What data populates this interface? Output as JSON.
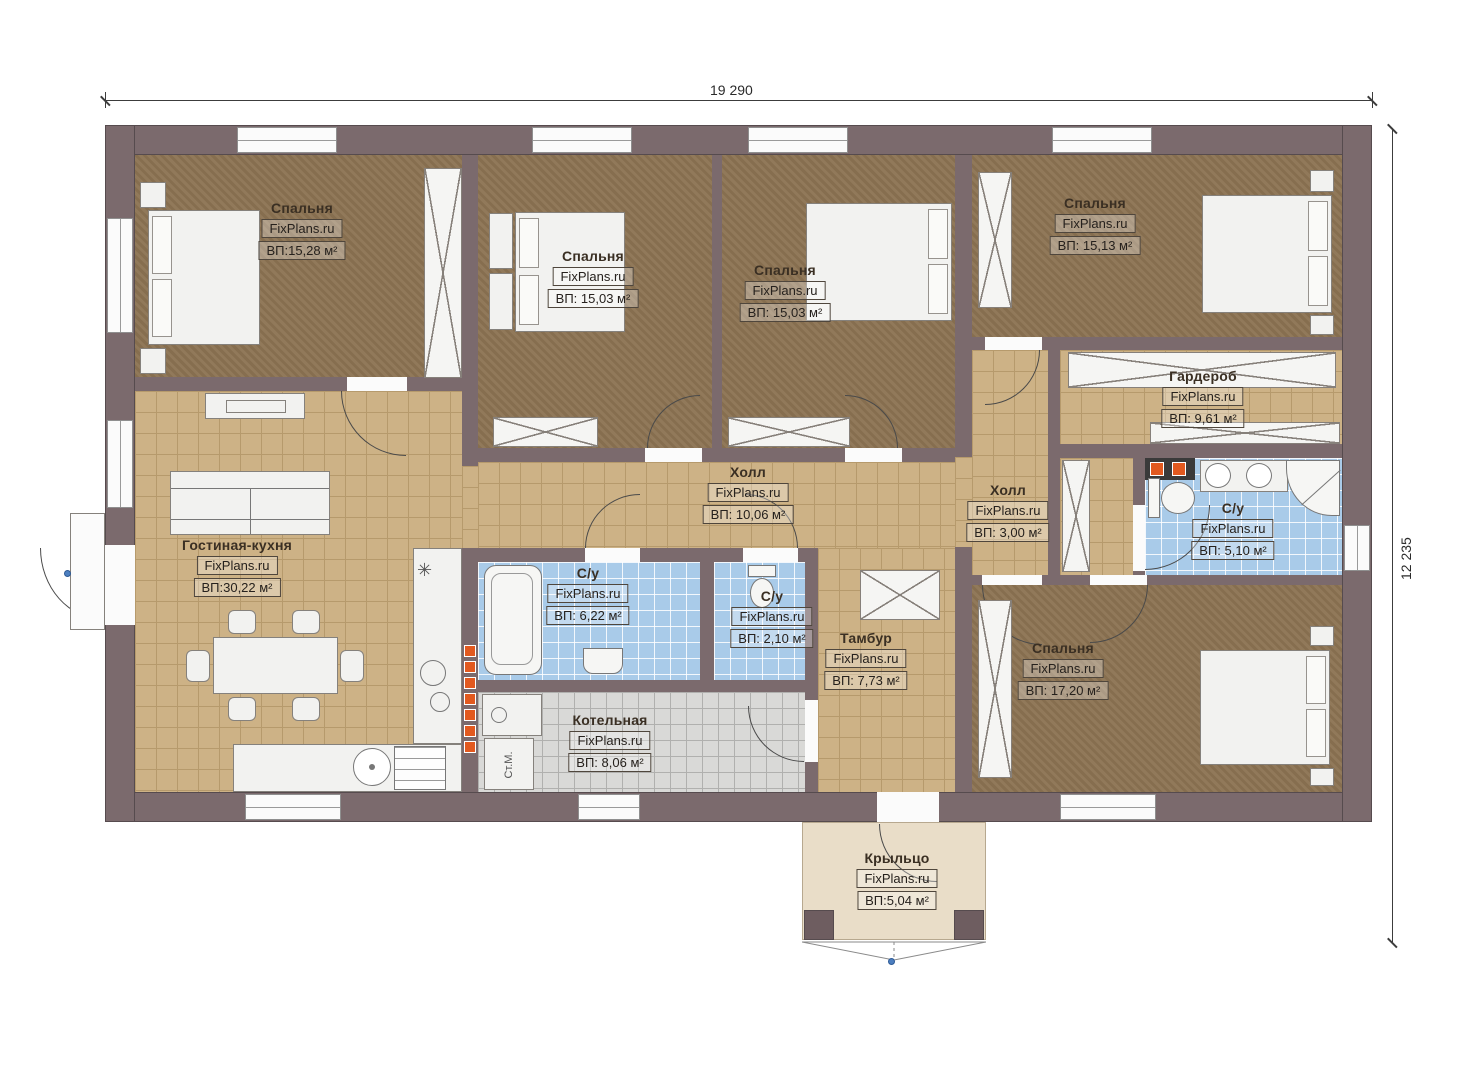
{
  "watermark": "FixPlans.ru",
  "dimensions": {
    "width": "19 290",
    "height": "12 235"
  },
  "labels": {
    "washing_machine": "Ст.М.",
    "kitchen_symbol": "✳"
  },
  "rooms": {
    "bedroom1": {
      "name": "Спальня",
      "area": "ВП:15,28 м²"
    },
    "bedroom2": {
      "name": "Спальня",
      "area": "ВП: 15,03 м²"
    },
    "bedroom3": {
      "name": "Спальня",
      "area": "ВП: 15,03 м²"
    },
    "bedroom4": {
      "name": "Спальня",
      "area": "ВП: 15,13 м²"
    },
    "bedroom5": {
      "name": "Спальня",
      "area": "ВП: 17,20 м²"
    },
    "wardrobe": {
      "name": "Гардероб",
      "area": "ВП: 9,61 м²"
    },
    "hall_main": {
      "name": "Холл",
      "area": "ВП: 10,06 м²"
    },
    "hall_small": {
      "name": "Холл",
      "area": "ВП: 3,00 м²"
    },
    "bath_master": {
      "name": "С/у",
      "area": "ВП: 5,10 м²"
    },
    "bath_main": {
      "name": "С/у",
      "area": "ВП: 6,22 м²"
    },
    "bath_guest": {
      "name": "С/у",
      "area": "ВП: 2,10 м²"
    },
    "living_kitchen": {
      "name": "Гостиная-кухня",
      "area": "ВП:30,22 м²"
    },
    "tambour": {
      "name": "Тамбур",
      "area": "ВП: 7,73 м²"
    },
    "boiler": {
      "name": "Котельная",
      "area": "ВП: 8,06 м²"
    },
    "porch": {
      "name": "Крыльцо",
      "area": "ВП:5,04 м²"
    }
  },
  "colors": {
    "wall": "#7b6a6d",
    "bedroom_floor": "#8d7453",
    "tile_floor": "#cdb286",
    "bath_floor": "#a9cbe9",
    "boiler_floor": "#d9d9d7",
    "porch_floor": "#e9ddc8",
    "accent_orange": "#e2591f"
  }
}
